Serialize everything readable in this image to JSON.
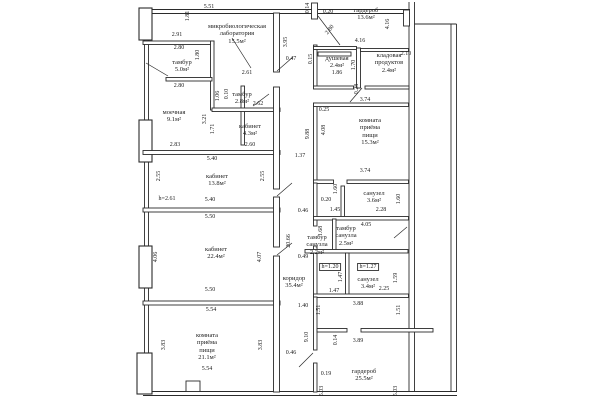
{
  "plan": {
    "rooms": [
      {
        "name": "микробиологическая лаборатория",
        "area": "15.5м²"
      },
      {
        "name": "тамбур",
        "area": "5.0м²"
      },
      {
        "name": "тамбур",
        "area": "2.8м²"
      },
      {
        "name": "моечная",
        "area": "9.1м²"
      },
      {
        "name": "кабинет",
        "area": "4.3м²"
      },
      {
        "name": "кабинет",
        "area": "13.8м²"
      },
      {
        "name": "кабинет",
        "area": "22.4м²"
      },
      {
        "name": "комната приёма пищи",
        "area": "21.1м²"
      },
      {
        "name": "гардероб",
        "area": "13.6м²"
      },
      {
        "name": "душевая",
        "area": "2.4м²"
      },
      {
        "name": "кладовая продуктов",
        "area": "2.4м²"
      },
      {
        "name": "комната приёма пищи",
        "area": "15.3м²"
      },
      {
        "name": "санузел",
        "area": "3.6м²"
      },
      {
        "name": "тамбур санузла",
        "area": "2.5м²"
      },
      {
        "name": "тамбур санузла",
        "area": "2.2м²"
      },
      {
        "name": "санузел",
        "area": "3.4м²"
      },
      {
        "name": "гардероб",
        "area": "25.5м²"
      },
      {
        "name": "коридор",
        "area": "35.4м²"
      }
    ],
    "dims": [
      "5.51",
      "1.81",
      "2.91",
      "2.80",
      "1.80",
      "2.61",
      "2.80",
      "1.06",
      "0.10",
      "2.62",
      "3.21",
      "1.71",
      "2.83",
      "2.60",
      "5.40",
      "2.55",
      "2.55",
      "h=2.61",
      "5.40",
      "5.50",
      "4.06",
      "4.07",
      "5.50",
      "5.54",
      "3.83",
      "3.83",
      "5.54",
      "3.95",
      "0.47",
      "1.37",
      "0.46",
      "20.66",
      "0.49",
      "1.40",
      "9.10",
      "0.46",
      "0.14",
      "0.20",
      "4.16",
      "2.80",
      "4.16",
      "0.15",
      "1.86",
      "1.70",
      "2.10",
      "0.28",
      "3.74",
      "0.25",
      "9.88",
      "4.08",
      "3.74",
      "1.60",
      "0.20",
      "1.45",
      "2.28",
      "1.60",
      "1.68",
      "4.05",
      "h=1.20",
      "h=1.27",
      "1.47",
      "2.25",
      "1.47",
      "1.59",
      "1.51",
      "3.88",
      "1.51",
      "0.14",
      "3.89",
      "0.19",
      "5.03",
      "5.03"
    ]
  }
}
